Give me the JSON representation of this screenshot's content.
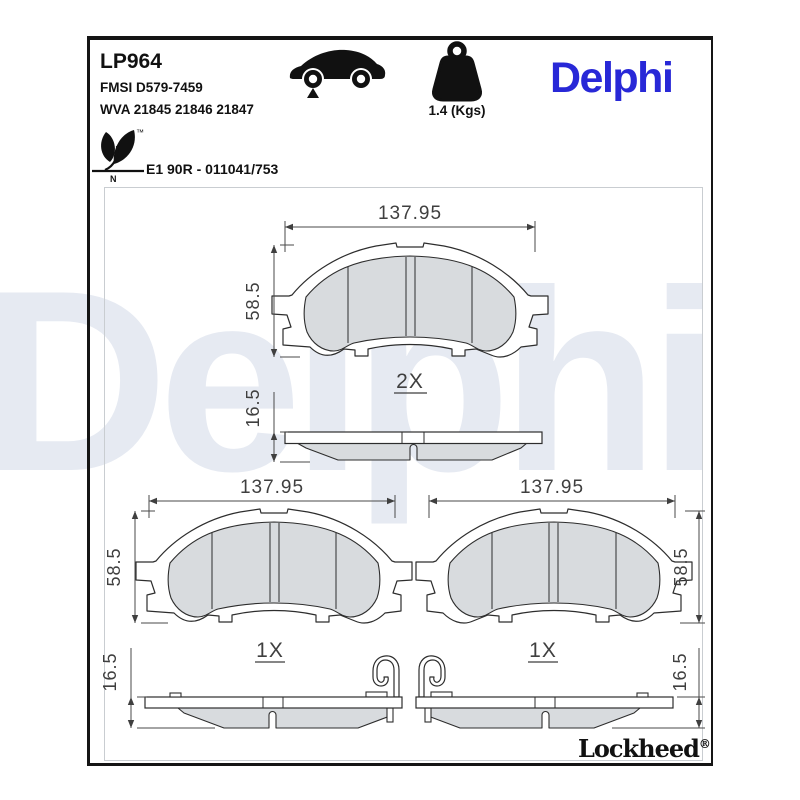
{
  "header": {
    "part_number": "LP964",
    "fmsi_code": "FMSI D579-7459",
    "wva_code": "WVA 21845 21846 21847",
    "homologation": "E1 90R - 011041/753",
    "eco_letter": "N",
    "trademark_symbol": "™",
    "weight_label": "1.4 (Kgs)",
    "brand": "Delphi"
  },
  "footer": {
    "sub_brand": "Lockheed",
    "registered_symbol": "®"
  },
  "watermark": "Delphi",
  "drawings": {
    "top_pad": {
      "width_mm": "137.95",
      "height_mm": "58.5",
      "thickness_mm": "16.5",
      "quantity": "2X"
    },
    "bottom_left_pad": {
      "width_mm": "137.95",
      "height_mm": "58.5",
      "thickness_mm": "16.5",
      "quantity": "1X"
    },
    "bottom_right_pad": {
      "width_mm": "137.95",
      "height_mm": "58.5",
      "thickness_mm": "16.5",
      "quantity": "1X"
    }
  },
  "colors": {
    "brand_blue": "#2828D7",
    "friction_gray": "#D8DBDE",
    "line_dark": "#2D2D2D",
    "dim_gray": "#3F3F3F",
    "watermark_blue": "#E6EAF2"
  }
}
